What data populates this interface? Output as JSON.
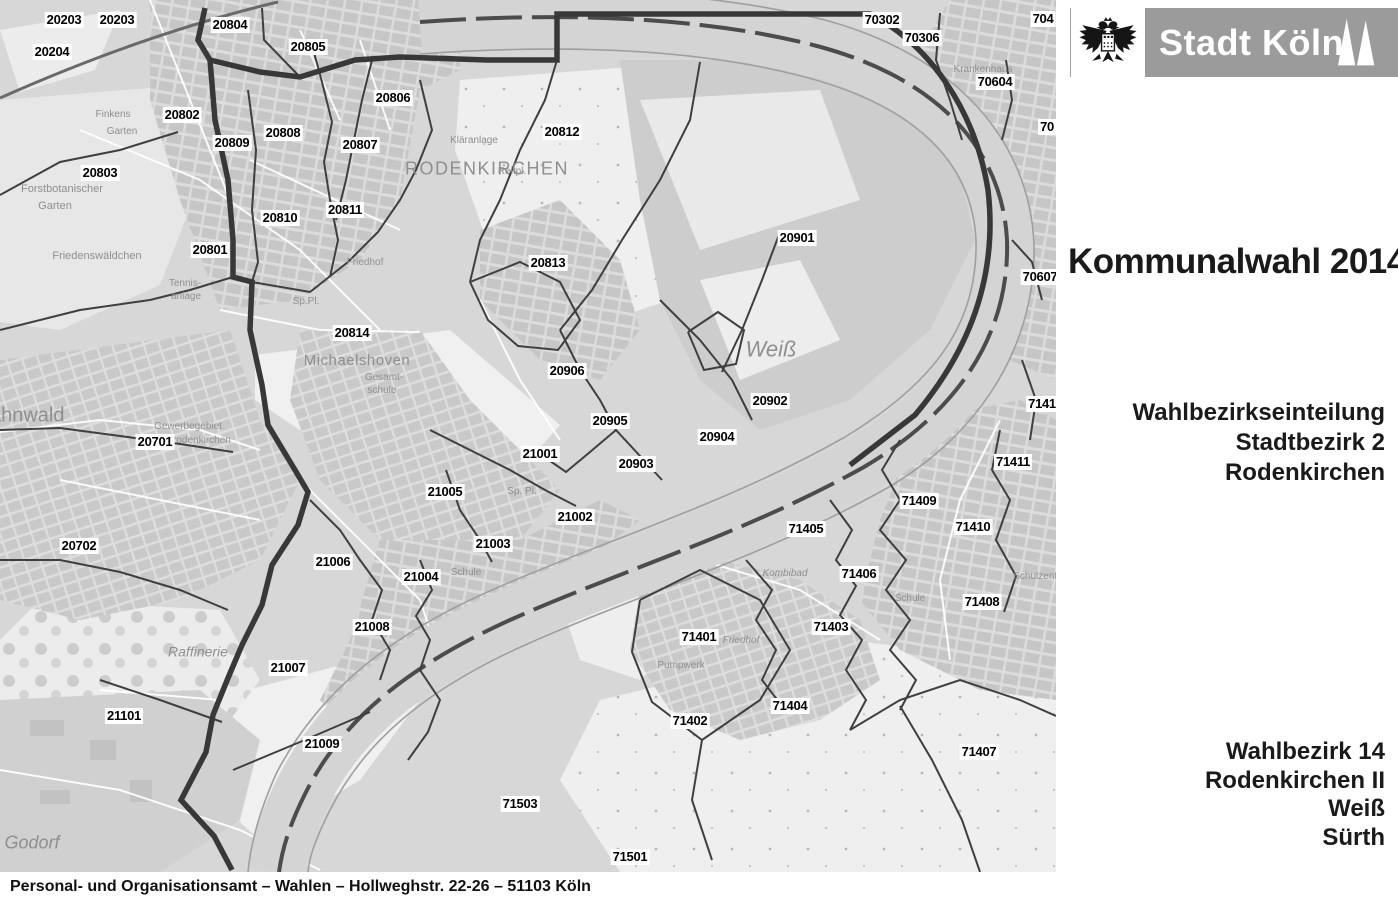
{
  "header": {
    "logo": {
      "city_name": "Stadt Köln",
      "coat_of_arms_icon": "cologne-eagle-icon",
      "spires_icon": "cathedral-spires-icon"
    },
    "title": "Kommunalwahl 2014"
  },
  "panel": {
    "subtitle": {
      "line1": "Wahlbezirkseinteilung",
      "line2": "Stadtbezirk 2",
      "line3": "Rodenkirchen"
    },
    "wahlbezirk": {
      "line1": "Wahlbezirk 14",
      "line2": "Rodenkirchen II",
      "line3": "Weiß",
      "line4": "Sürth"
    }
  },
  "footer": {
    "text": "Personal- und Organisationsamt – Wahlen – Hollweghstr. 22-26 – 51103 Köln"
  },
  "map": {
    "colors": {
      "background": "#d7d7d7",
      "water": "#d4d4d4",
      "boundary_thick": "#383838",
      "boundary_thin": "#3f3f3f",
      "urban_block": "#c6c6c6",
      "field_light": "#efefef",
      "district_label_text": "#000000",
      "place_label_text": "#8f8f8f",
      "banner_gray": "#9b9b9b"
    },
    "district_labels": [
      {
        "n": "20203",
        "x": 64,
        "y": 20
      },
      {
        "n": "20203",
        "x": 117,
        "y": 20
      },
      {
        "n": "20204",
        "x": 52,
        "y": 52
      },
      {
        "n": "20804",
        "x": 230,
        "y": 25
      },
      {
        "n": "20805",
        "x": 308,
        "y": 47
      },
      {
        "n": "20806",
        "x": 393,
        "y": 98
      },
      {
        "n": "20802",
        "x": 182,
        "y": 115
      },
      {
        "n": "20809",
        "x": 232,
        "y": 143
      },
      {
        "n": "20808",
        "x": 283,
        "y": 133
      },
      {
        "n": "20807",
        "x": 360,
        "y": 145
      },
      {
        "n": "20812",
        "x": 562,
        "y": 132
      },
      {
        "n": "20803",
        "x": 100,
        "y": 173
      },
      {
        "n": "20810",
        "x": 280,
        "y": 218
      },
      {
        "n": "20811",
        "x": 345,
        "y": 210
      },
      {
        "n": "20801",
        "x": 210,
        "y": 250
      },
      {
        "n": "20813",
        "x": 548,
        "y": 263
      },
      {
        "n": "20901",
        "x": 797,
        "y": 238
      },
      {
        "n": "70302",
        "x": 882,
        "y": 20
      },
      {
        "n": "70306",
        "x": 922,
        "y": 38
      },
      {
        "n": "704",
        "x": 1043,
        "y": 19
      },
      {
        "n": "70604",
        "x": 995,
        "y": 82
      },
      {
        "n": "70",
        "x": 1047,
        "y": 127
      },
      {
        "n": "70607",
        "x": 1040,
        "y": 277
      },
      {
        "n": "20814",
        "x": 352,
        "y": 333
      },
      {
        "n": "20906",
        "x": 567,
        "y": 371
      },
      {
        "n": "20902",
        "x": 770,
        "y": 401
      },
      {
        "n": "20905",
        "x": 610,
        "y": 421
      },
      {
        "n": "20904",
        "x": 717,
        "y": 437
      },
      {
        "n": "21001",
        "x": 540,
        "y": 454
      },
      {
        "n": "20903",
        "x": 636,
        "y": 464
      },
      {
        "n": "7141",
        "x": 1042,
        "y": 404
      },
      {
        "n": "71411",
        "x": 1013,
        "y": 462
      },
      {
        "n": "21005",
        "x": 445,
        "y": 492
      },
      {
        "n": "71409",
        "x": 919,
        "y": 501
      },
      {
        "n": "71410",
        "x": 973,
        "y": 527
      },
      {
        "n": "21002",
        "x": 575,
        "y": 517
      },
      {
        "n": "71405",
        "x": 806,
        "y": 529
      },
      {
        "n": "21003",
        "x": 493,
        "y": 544
      },
      {
        "n": "20701",
        "x": 155,
        "y": 442
      },
      {
        "n": "20702",
        "x": 79,
        "y": 546
      },
      {
        "n": "21006",
        "x": 333,
        "y": 562
      },
      {
        "n": "71406",
        "x": 859,
        "y": 574
      },
      {
        "n": "21004",
        "x": 421,
        "y": 577
      },
      {
        "n": "71408",
        "x": 982,
        "y": 602
      },
      {
        "n": "21008",
        "x": 372,
        "y": 627
      },
      {
        "n": "71403",
        "x": 831,
        "y": 627
      },
      {
        "n": "71401",
        "x": 699,
        "y": 637
      },
      {
        "n": "21007",
        "x": 288,
        "y": 668
      },
      {
        "n": "71402",
        "x": 690,
        "y": 721
      },
      {
        "n": "71404",
        "x": 790,
        "y": 706
      },
      {
        "n": "71407",
        "x": 979,
        "y": 752
      },
      {
        "n": "21101",
        "x": 124,
        "y": 716
      },
      {
        "n": "21009",
        "x": 322,
        "y": 744
      },
      {
        "n": "71503",
        "x": 520,
        "y": 804
      },
      {
        "n": "71501",
        "x": 630,
        "y": 857
      }
    ],
    "place_labels": [
      {
        "t": "RODENKIRCHEN",
        "x": 487,
        "y": 169,
        "s": 18,
        "sp": 1.5
      },
      {
        "t": "Michaelshoven",
        "x": 357,
        "y": 361,
        "s": 15,
        "sp": 0.5
      },
      {
        "t": "Weiß",
        "x": 771,
        "y": 349,
        "s": 22,
        "it": true
      },
      {
        "t": "Hahnwald",
        "x": 20,
        "y": 416,
        "s": 20
      },
      {
        "t": "Raffinerie",
        "x": 198,
        "y": 652,
        "s": 14,
        "it": true
      },
      {
        "t": "Godorf",
        "x": 32,
        "y": 843,
        "s": 18,
        "it": true
      },
      {
        "t": "Forstbotanischer",
        "x": 62,
        "y": 190,
        "s": 11
      },
      {
        "t": "Garten",
        "x": 55,
        "y": 207,
        "s": 11
      },
      {
        "t": "Friedenswäldchen",
        "x": 97,
        "y": 257,
        "s": 11
      },
      {
        "t": "Finkens",
        "x": 113,
        "y": 115,
        "s": 10
      },
      {
        "t": "Garten",
        "x": 122,
        "y": 132,
        "s": 10
      },
      {
        "t": "Friedhof",
        "x": 365,
        "y": 263,
        "s": 10
      },
      {
        "t": "Friedhof",
        "x": 741,
        "y": 641,
        "s": 10,
        "it": true
      },
      {
        "t": "Sp.Pl.",
        "x": 306,
        "y": 302,
        "s": 10
      },
      {
        "t": "Sp. Pl.",
        "x": 522,
        "y": 492,
        "s": 10
      },
      {
        "t": "Tennis-",
        "x": 185,
        "y": 284,
        "s": 10
      },
      {
        "t": "anlage",
        "x": 186,
        "y": 297,
        "s": 10
      },
      {
        "t": "Gesamt-",
        "x": 384,
        "y": 378,
        "s": 10
      },
      {
        "t": "schule",
        "x": 382,
        "y": 391,
        "s": 10
      },
      {
        "t": "Kombibad",
        "x": 785,
        "y": 574,
        "s": 10,
        "it": true
      },
      {
        "t": "Schule",
        "x": 910,
        "y": 599,
        "s": 10
      },
      {
        "t": "Schule",
        "x": 466,
        "y": 573,
        "s": 10
      },
      {
        "t": "Pumpwerk",
        "x": 681,
        "y": 666,
        "s": 10
      },
      {
        "t": "Krankenhaus",
        "x": 983,
        "y": 70,
        "s": 10
      },
      {
        "t": "Gewerbegebiet",
        "x": 188,
        "y": 427,
        "s": 10
      },
      {
        "t": "Rodenkirchen",
        "x": 200,
        "y": 441,
        "s": 10
      },
      {
        "t": "Kläranlage",
        "x": 474,
        "y": 141,
        "s": 10
      },
      {
        "t": "Schulzentr.",
        "x": 1038,
        "y": 577,
        "s": 10
      },
      {
        "t": "Reitpl.",
        "x": 512,
        "y": 172,
        "s": 10
      }
    ]
  }
}
